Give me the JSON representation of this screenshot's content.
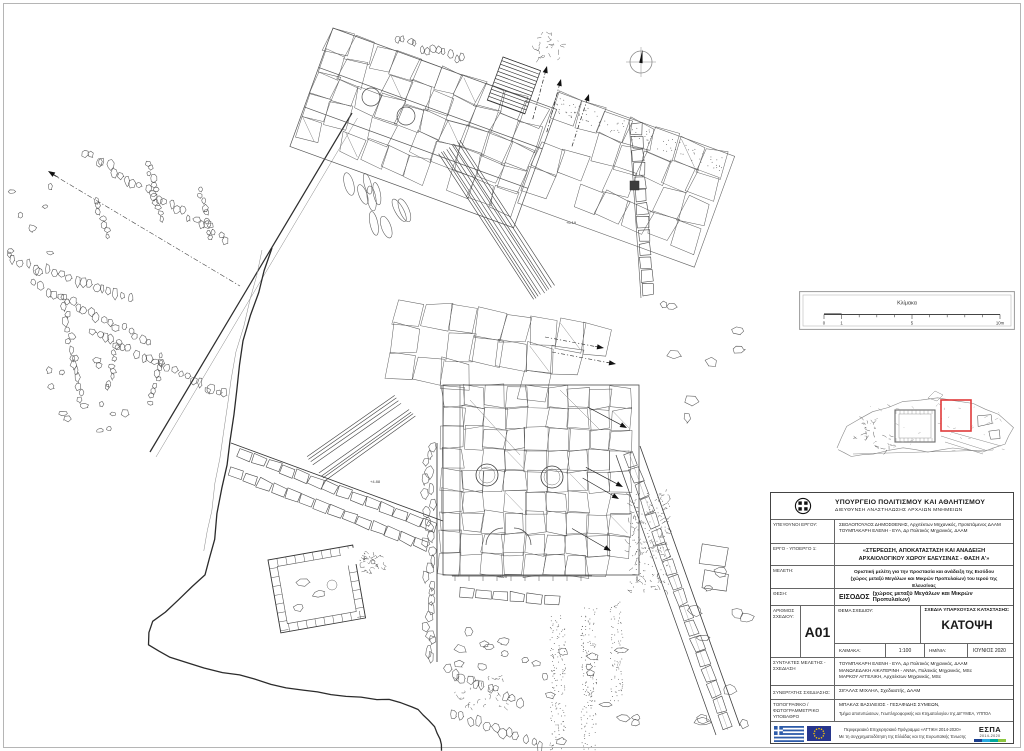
{
  "colors": {
    "highlight_red": "#e03a3a",
    "line_dark": "#2e2e2e",
    "line_mid": "#565656",
    "flag_blue": "#2d5ba9",
    "eu_blue": "#26358c",
    "eu_star": "#ffcc00",
    "espa_bar": [
      "#1b3f8f",
      "#29abe2",
      "#00a99d",
      "#8cc63f"
    ]
  },
  "drawing": {
    "spot_elevations": [
      "+8.20",
      "+6.19",
      "+4.88"
    ]
  },
  "scale_box": {
    "title": "Κλίμακα",
    "ticks": [
      "0",
      "1",
      "5",
      "10m"
    ]
  },
  "title_block": {
    "header": {
      "ministry": "ΥΠΟΥΡΓΕΙΟ ΠΟΛΙΤΙΣΜΟΥ ΚΑΙ ΑΘΛΗΤΙΣΜΟΥ",
      "directorate": "ΔΙΕΥΘΥΝΣΗ ΑΝΑΣΤΗΛΩΣΗΣ ΑΡΧΑΙΩΝ ΜΝΗΜΕΙΩΝ"
    },
    "supervisors": {
      "label": "ΥΠΕΥΘΥΝΟΙ ΕΡΓΟΥ:",
      "lines": [
        "ΣΒΟΛΟΠΟΥΛΟΣ ΔΗΜΟΣΘΕΝΗΣ, Αρχιτέκτων Μηχανικός, Προϊστάμενος ΔΑΑΜ",
        "ΤΟΥΜΠΑΚΑΡΗ ΕΛΕΝΗ - ΕΥΑ, Δρ Πολιτικός Μηχανικός, ΔΑΑΜ"
      ]
    },
    "project": {
      "label": "ΕΡΓΟ - ΥΠΟΕΡΓΟ 1:",
      "lines": [
        "«ΣΤΕΡΕΩΣΗ, ΑΠΟΚΑΤΑΣΤΑΣΗ ΚΑΙ ΑΝΑΔΕΙΞΗ",
        "ΑΡΧΑΙΟΛΟΓΙΚΟΥ ΧΩΡΟΥ ΕΛΕΥΣΙΝΑΣ - ΦΑΣΗ Α'»"
      ]
    },
    "study": {
      "label": "ΜΕΛΕΤΗ:",
      "lines": [
        "Οριστική μελέτη για την προστασία και ανάδειξη της Εισόδου",
        "(χώρος μεταξύ Μεγάλων και Μικρών Προπυλαίων) του Ιερού της Ελευσίνας"
      ]
    },
    "location": {
      "label": "ΘΕΣΗ:",
      "value_main": "ΕΙΣΟΔΟΣ",
      "value_detail": "(χώρος μεταξύ Μεγάλων και Μικρών Προπυλαίων)"
    },
    "number": {
      "label": "ΑΡΙΘΜΟΣ ΣΧΕΔΙΟΥ:",
      "value": "A01"
    },
    "subject": {
      "label": "ΘΕΜΑ ΣΧΕΔΙΟΥ:"
    },
    "state": {
      "label": "ΣΧΕΔΙΑ ΥΠΑΡΧΟΥΣΑΣ ΚΑΤΑΣΤΑΣΗΣ:",
      "value": "ΚΑΤΟΨΗ"
    },
    "scale": {
      "label": "ΚΛΙΜΑΚΑ:",
      "value": "1:100"
    },
    "date": {
      "label": "ΗΜ/ΝΙΑ:",
      "value": "ΙΟΥΝΙΟΣ 2020"
    },
    "authors": {
      "label": "ΣΥΝΤΑΚΤΕΣ ΜΕΛΕΤΗΣ - ΣΧΕΔΙΑΣΗ",
      "lines": [
        "ΤΟΥΜΠΑΚΑΡΗ ΕΛΕΝΗ - ΕΥΑ, Δρ Πολιτικός Μηχανικός, ΔΑΑΜ",
        "ΜΑΝΩΛΕΔΑΚΗ ΑΙΚΑΤΕΡΙΝΗ - ΑΝΝΑ, Πολιτικός Μηχανικός, MSc",
        "ΜΑΡΚΟΥ ΑΓΓΕΛΙΚΗ, Αρχιτέκτων Μηχανικός, MSc"
      ]
    },
    "collaborator": {
      "label": "ΣΥΝΕΡΓΑΤΗΣ ΣΧΕΔΙΑΣΗΣ:",
      "value": "ΣΙΓΑΛΑΣ ΜΙΧΑΗΛ, Σχεδιαστής, ΔΑΑΜ"
    },
    "base_map": {
      "label": "ΤΟΠΟΓΡΑΦΙΚΟ / ΦΩΤΟΓΡΑΜΜΕΤΡΙΚΟ ΥΠΟΒΑΘΡΟ",
      "lines": [
        "ΜΠΑΚΑΣ ΒΑΣΙΛΕΙΟΣ - ΓΕΣΑΦΙΔΗΣ ΣΥΜΕΩΝ,",
        "Τμήμα αποτυπώσεων, Γεωπληροφορικής και Κτηματολογίου της ΔΙΓΥΜΕΑ, ΥΠΠΟΑ"
      ]
    },
    "funding": {
      "lines": [
        "Περιφερειακό Επιχειρησιακό Πρόγραμμα «ΑΤΤΙΚΗ 2014-2020»",
        "Με τη συγχρηματοδότηση της Ελλάδας και της Ευρωπαϊκής Ένωσης"
      ],
      "espa": "ΕΣΠΑ",
      "espa_years": "2014-2020"
    }
  }
}
